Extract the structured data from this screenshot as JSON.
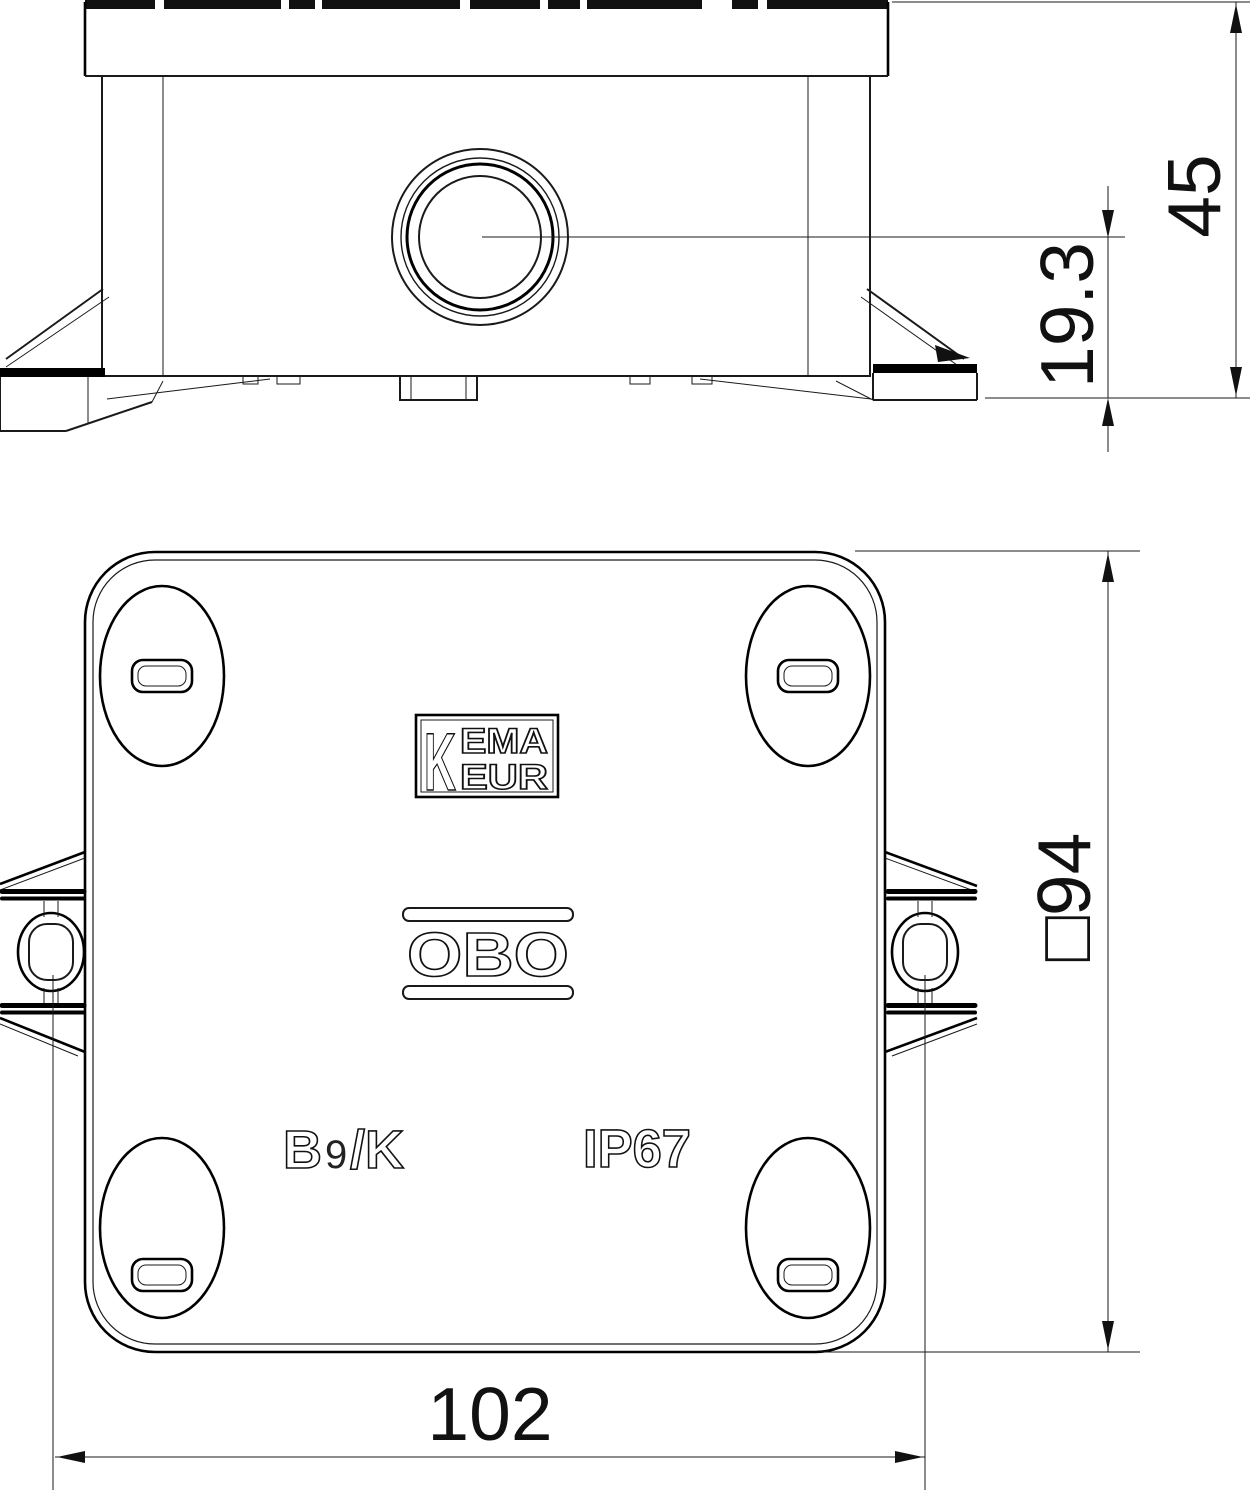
{
  "drawing": {
    "title_hint": "junction box two-view dimensional drawing",
    "side_view": {
      "dim_total_height": "45",
      "dim_gland_center_height": "19.3"
    },
    "plan_view": {
      "dim_body_square": "□94",
      "dim_mounting_width": "102",
      "kema_logo": {
        "k": "K",
        "line1": "EMA",
        "line2": "EUR"
      },
      "obo_logo": "OBO",
      "type_label_b": "B",
      "type_label_9": "9",
      "type_label_k": "/K",
      "ip_rating": "IP67"
    },
    "colors": {
      "line": "#1a1a1a",
      "background": "#ffffff"
    }
  }
}
